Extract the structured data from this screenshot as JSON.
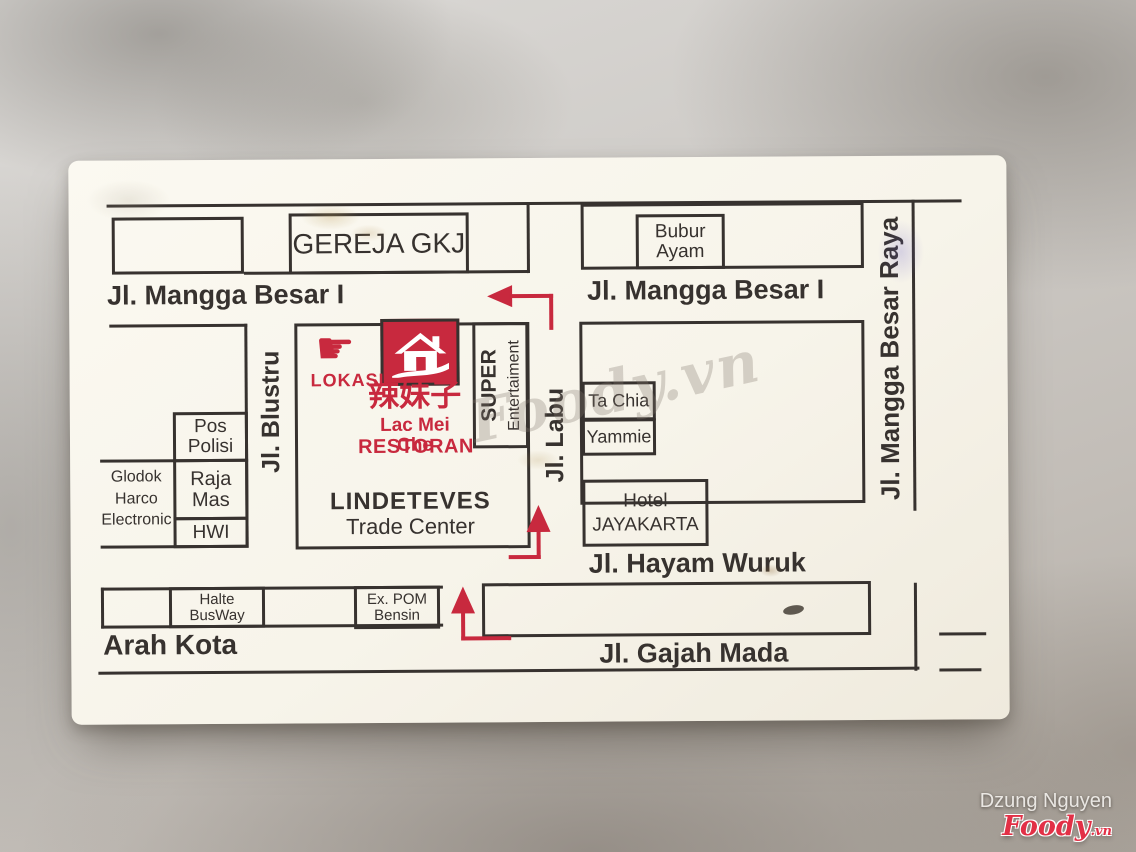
{
  "colors": {
    "accent_red": "#c8293e",
    "ink": "#37322f",
    "card_bg": "#f8f5ec"
  },
  "streets": {
    "mangga_besar_1_left": "Jl. Mangga Besar I",
    "mangga_besar_1_right": "Jl. Mangga Besar I",
    "mangga_besar_raya": "Jl. Mangga Besar Raya",
    "blustru": "Jl. Blustru",
    "labu": "Jl. Labu",
    "hayam_wuruk": "Jl. Hayam Wuruk",
    "gajah_mada": "Jl. Gajah Mada",
    "arah_kota": "Arah Kota"
  },
  "buildings": {
    "gereja": "GEREJA GKJ",
    "bubur": "Bubur\nAyam",
    "pos_polisi": "Pos\nPolisi",
    "raja_mas": "Raja\nMas",
    "hwi": "HWI",
    "glodok": "Glodok\nHarco\nElectronic",
    "super_line1": "SUPER",
    "super_line2": "Entertaiment",
    "lindeteves_line1": "LINDETEVES",
    "lindeteves_line2": "Trade Center",
    "ta_chia": "Ta Chia",
    "yammie": "Yammie",
    "hotel": "Hotel\nJAYAKARTA",
    "halte_busway": "Halte\nBusWay",
    "ex_pom_bensin": "Ex. POM\nBensin"
  },
  "restaurant": {
    "lokasi": "LOKASI",
    "chinese": "辣妹子",
    "name": "Lac Mei Che",
    "type": "RESTORAN",
    "pointing_hand_glyph": "☛"
  },
  "watermark": {
    "center": "Foody.vn",
    "author": "Dzung Nguyen",
    "brand": "Foody",
    "brand_suffix": ".vn"
  }
}
